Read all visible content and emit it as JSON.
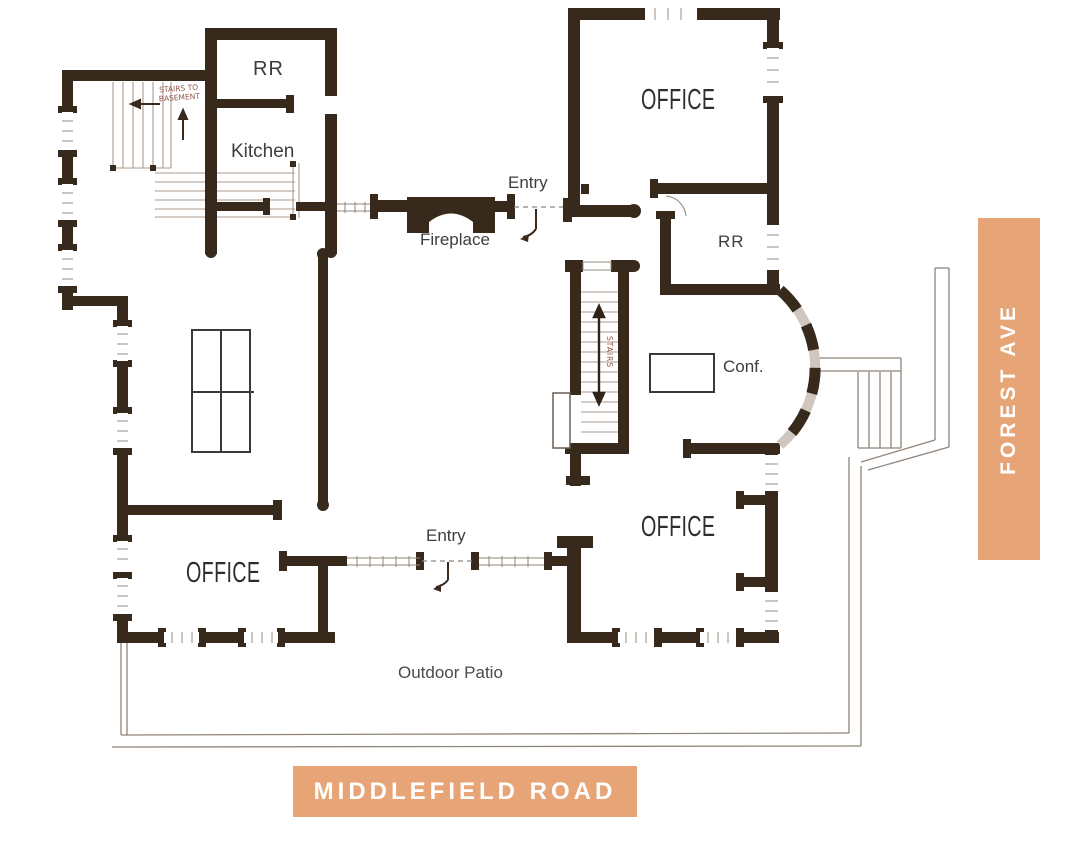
{
  "canvas": {
    "width": 1073,
    "height": 845,
    "background": "#FFFFFF"
  },
  "streets": {
    "forest_ave": {
      "label": "FOREST AVE",
      "banner_color": "#E7A577",
      "text_color": "#FFFFFF"
    },
    "middlefield_road": {
      "label": "MIDDLEFIELD ROAD",
      "banner_color": "#E7A577",
      "text_color": "#FFFFFF"
    }
  },
  "rooms": {
    "rr_top": {
      "label": "RR"
    },
    "kitchen": {
      "label": "Kitchen"
    },
    "office_top_right": {
      "label": "OFFICE"
    },
    "rr_right": {
      "label": "RR"
    },
    "conference": {
      "label": "Conf."
    },
    "office_bottom_right": {
      "label": "OFFICE"
    },
    "office_bottom_left": {
      "label": "OFFICE"
    }
  },
  "annotations": {
    "entry_top": {
      "label": "Entry"
    },
    "entry_bottom": {
      "label": "Entry"
    },
    "fireplace": {
      "label": "Fireplace"
    },
    "outdoor_patio": {
      "label": "Outdoor Patio"
    },
    "basement_stairs_note": {
      "label": "STAIRS TO BASEMENT"
    },
    "central_stairs_note": {
      "label": "STAIRS"
    }
  },
  "colors": {
    "wall": "#38291D",
    "thin_line": "#8F8478",
    "stair_line": "#A89A8C",
    "label_text": "#3B3B3B",
    "handwriting": "#95584A",
    "street_banner": "#E7A577"
  }
}
